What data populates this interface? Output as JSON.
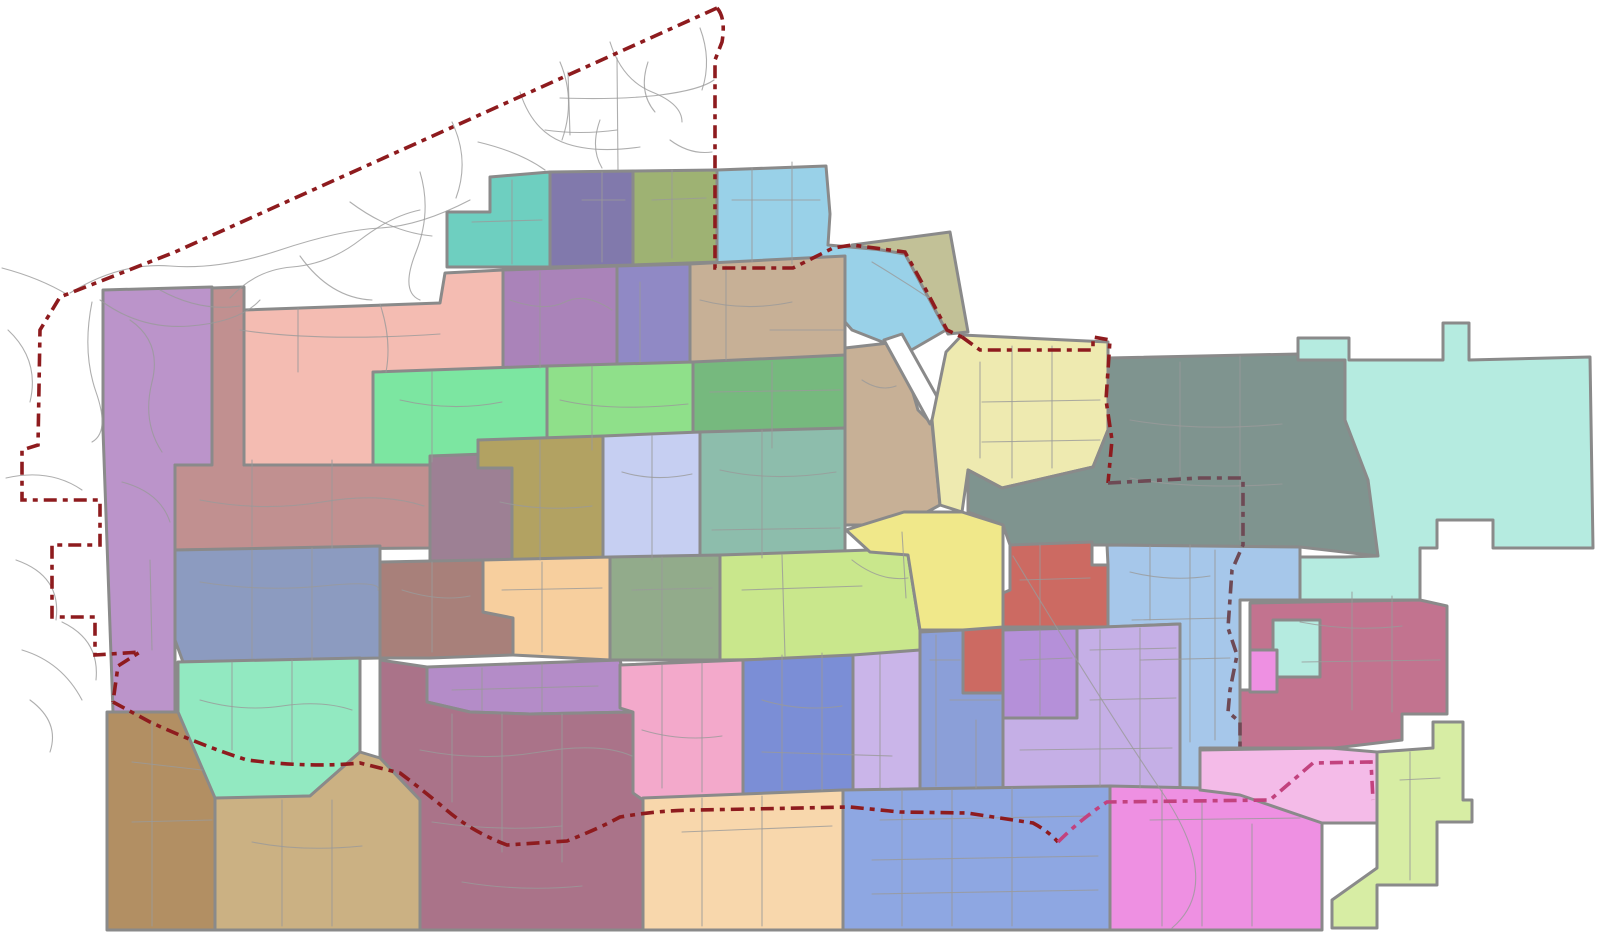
{
  "map": {
    "canvas": {
      "width": 1618,
      "height": 951,
      "background": "#ffffff"
    },
    "styles": {
      "region_stroke": "#8a8a8a",
      "region_stroke_width": 3,
      "road_color": "#9a9a9a",
      "road_width": 1.1,
      "road_opacity": 0.8,
      "boundary_width": 3.6,
      "boundary_dash": "13 6 5 6",
      "boundary_main_color": "#8e1b1e",
      "boundary_magenta_color": "#c2427e",
      "boundary_inner_color": "#6e4a55"
    },
    "regions": [
      {
        "id": "purple-strip-west",
        "fill": "#bb94ca",
        "points": "103,290 212,287 212,465 175,465 175,712 113,712 103,430"
      },
      {
        "id": "teal-north",
        "fill": "#6ecfc0",
        "points": "447,212 490,212 490,177 550,172 550,267 447,267"
      },
      {
        "id": "slate-purple-north",
        "fill": "#8179ac",
        "points": "550,172 633,171 633,265 550,267"
      },
      {
        "id": "moss-north",
        "fill": "#9eb273",
        "points": "633,171 717,170 717,262 633,265"
      },
      {
        "id": "light-blue-north",
        "fill": "#99d1e8",
        "points": "717,170 826,166 830,214 828,245 850,247 905,252 946,330 908,352 852,330 826,300 793,268 717,268"
      },
      {
        "id": "khaki-olive-ne",
        "fill": "#c2c197",
        "points": "852,245 950,232 968,332 948,334 905,254"
      },
      {
        "id": "rosy-brown-west",
        "fill": "#c19090",
        "points": "212,288 244,287 244,465 430,458 430,548 175,550 175,465 212,465"
      },
      {
        "id": "salmon",
        "fill": "#f4bcb2",
        "points": "244,310 440,303 445,273 503,270 503,370 373,373 373,465 244,465"
      },
      {
        "id": "mauve-central",
        "fill": "#aa83b9",
        "points": "503,270 617,266 617,368 503,370"
      },
      {
        "id": "purple-blue-central",
        "fill": "#9089c5",
        "points": "617,266 690,264 690,366 617,368"
      },
      {
        "id": "tan-central",
        "fill": "#c7b096",
        "points": "690,264 845,256 845,362 690,362"
      },
      {
        "id": "tan-east-arm",
        "fill": "#c7b096",
        "points": "845,348 898,342 918,410 932,424 940,505 903,525 845,525 845,430"
      },
      {
        "id": "white-corridor",
        "fill": "#ffffff",
        "points": "884,340 902,334 940,402 930,424"
      },
      {
        "id": "bright-green",
        "fill": "#7ce6a1",
        "points": "373,372 547,366 547,440 478,440 478,465 373,465"
      },
      {
        "id": "light-green",
        "fill": "#8fe08a",
        "points": "547,366 693,362 693,450 547,452"
      },
      {
        "id": "sage-green",
        "fill": "#76b97e",
        "points": "693,362 845,355 845,450 693,450"
      },
      {
        "id": "pale-yellow-east",
        "fill": "#eeeab0",
        "points": "946,352 962,335 1108,342 1108,430 1093,467 1002,488 968,470 962,512 940,505 932,420"
      },
      {
        "id": "slate-gray-green",
        "fill": "#7f948f",
        "points": "1108,430 1108,358 1345,353 1345,420 1368,480 1378,556 1300,547 1107,545 1010,545 1003,525 968,512 968,470 1002,488 1093,467"
      },
      {
        "id": "pale-cyan-east",
        "fill": "#b5ebe0",
        "points": "1345,360 1298,360 1298,338 1349,338 1349,360 1443,360 1443,323 1469,323 1469,360 1590,357 1593,548 1493,548 1493,520 1437,520 1437,548 1420,548 1420,600 1300,600 1300,557 1345,557 1378,556 1368,480 1345,420"
      },
      {
        "id": "mauve-gray-mid",
        "fill": "#9d8094",
        "points": "430,456 512,453 512,562 430,562"
      },
      {
        "id": "dark-khaki-mid",
        "fill": "#b2a262",
        "points": "478,440 603,436 603,562 512,562 512,468 478,468"
      },
      {
        "id": "lavender-blue-mid",
        "fill": "#c6cff2",
        "points": "603,436 700,432 700,562 603,562"
      },
      {
        "id": "teal-green-mid",
        "fill": "#8dbdac",
        "points": "700,432 845,428 845,555 700,558"
      },
      {
        "id": "slate-blue-west",
        "fill": "#8c9bc0",
        "points": "175,550 380,546 380,658 183,662 175,640"
      },
      {
        "id": "taupe-mid",
        "fill": "#a8807a",
        "points": "380,562 483,560 483,612 513,618 513,655 430,658 380,658"
      },
      {
        "id": "peach-mid",
        "fill": "#f7cf9e",
        "points": "483,560 610,557 610,660 513,655 513,618 483,612"
      },
      {
        "id": "sage-green-south",
        "fill": "#92ab8b",
        "points": "610,557 720,555 720,660 610,660"
      },
      {
        "id": "yellow-green-mid",
        "fill": "#c9e78c",
        "points": "720,555 870,550 908,555 920,630 920,658 720,660"
      },
      {
        "id": "yellow-central",
        "fill": "#f0e88a",
        "points": "846,530 904,512 962,512 1003,525 1003,630 920,630 908,555 870,552"
      },
      {
        "id": "coral",
        "fill": "#cc6a62",
        "points": "1010,545 1092,542 1092,565 1108,565 1108,627 1003,627 1003,593 1010,590"
      },
      {
        "id": "coral-arm",
        "fill": "#cc6a62",
        "points": "963,630 1003,627 1003,693 963,693"
      },
      {
        "id": "light-blue-east",
        "fill": "#a6c7ea",
        "points": "1107,545 1300,547 1300,600 1240,600 1240,748 1200,748 1200,790 1180,790 1180,624 1108,627 1108,565"
      },
      {
        "id": "rose-east",
        "fill": "#c2738f",
        "points": "1250,603 1420,600 1447,606 1447,714 1402,714 1402,740 1335,748 1240,748 1240,690 1250,690"
      },
      {
        "id": "cyan-arm",
        "fill": "#b5ebe0",
        "points": "1273,620 1320,620 1320,677 1273,677"
      },
      {
        "id": "pink-notch",
        "fill": "#ee90e2",
        "points": "1250,650 1277,650 1277,692 1250,692"
      },
      {
        "id": "mint-south",
        "fill": "#92e9c1",
        "points": "178,662 360,658 360,752 310,796 215,800 178,715"
      },
      {
        "id": "purple-south",
        "fill": "#b48cc8",
        "points": "427,667 620,660 633,712 530,714 470,712 427,702"
      },
      {
        "id": "plum-south",
        "fill": "#aa7389",
        "points": "380,660 427,667 427,702 470,712 530,714 633,712 643,722 643,930 420,930 420,800 380,758"
      },
      {
        "id": "pink-south",
        "fill": "#f3a9cb",
        "points": "620,665 743,660 743,795 643,800 633,793 633,712 620,708"
      },
      {
        "id": "blue-purple-south",
        "fill": "#7b8ed6",
        "points": "743,660 853,655 853,790 743,795"
      },
      {
        "id": "lavender-west",
        "fill": "#cab5e9",
        "points": "853,655 920,650 920,790 853,790"
      },
      {
        "id": "blue-mid-south",
        "fill": "#8b9fd8",
        "points": "920,632 963,630 963,693 1003,693 1003,790 920,790"
      },
      {
        "id": "purple-block",
        "fill": "#b590d9",
        "points": "1003,630 1077,628 1077,718 1003,718"
      },
      {
        "id": "lavender-east",
        "fill": "#c5afe6",
        "points": "1077,628 1180,624 1180,790 1003,790 1003,718 1077,718"
      },
      {
        "id": "brown-sw",
        "fill": "#b28f63",
        "points": "107,712 178,712 215,798 215,930 107,930"
      },
      {
        "id": "tan-south",
        "fill": "#cbb183",
        "points": "215,798 310,796 360,752 380,758 420,800 420,930 215,930"
      },
      {
        "id": "peach-south",
        "fill": "#f8d7ac",
        "points": "643,798 843,790 843,930 643,930"
      },
      {
        "id": "blue-south",
        "fill": "#8ea7e2",
        "points": "843,790 1110,786 1110,930 843,930"
      },
      {
        "id": "bright-pink-south",
        "fill": "#ee90e2",
        "points": "1110,786 1200,788 1200,750 1240,748 1330,748 1322,823 1322,930 1110,930"
      },
      {
        "id": "light-pink-south",
        "fill": "#f4bbe8",
        "points": "1200,750 1330,748 1377,752 1377,823 1322,823 1240,795 1200,790"
      },
      {
        "id": "pale-green-se",
        "fill": "#d7eda4",
        "points": "1377,752 1433,748 1433,722 1463,722 1463,800 1472,800 1472,822 1437,822 1437,885 1377,885 1377,928 1332,928 1332,900 1377,868"
      }
    ],
    "roads": [
      "M70,293 Q120,262 170,266 T280,250 T380,228 T470,200",
      "M100,300 Q140,330 190,326 T260,300",
      "M230,298 Q255,270 292,267 T360,240 T420,210",
      "M300,256 Q330,298 372,300",
      "M420,172 Q432,212 416,252 T420,300",
      "M452,122 Q470,160 456,198",
      "M520,92 Q532,130 562,142 T640,147",
      "M560,62 Q576,100 562,140",
      "M610,42 Q622,80 652,92 T682,122",
      "M478,142 Q520,152 545,170",
      "M350,202 Q390,232 432,236",
      "M160,290 Q200,312 240,306",
      "M600,120 Q590,148 602,168",
      "M648,62 Q638,92 655,112",
      "M617,58 L618,170",
      "M560,98 Q620,100 660,95 T714,80",
      "M545,130 Q580,135 617,130",
      "M568,72 L570,135",
      "M670,140 Q690,155 712,152",
      "M700,28 Q712,60 702,90",
      "M2,268 Q40,278 68,295",
      "M8,330 Q40,360 30,402",
      "M6,478 Q50,468 82,490",
      "M16,560 Q62,576 56,620",
      "M22,650 Q62,662 82,700",
      "M62,622 Q100,640 96,680",
      "M30,700 Q60,722 50,752",
      "M92,302 Q82,352 96,392 T92,442",
      "M240,330 Q320,342 440,334",
      "M298,308 L298,372",
      "M380,304 Q392,340 386,372",
      "M130,320 Q162,342 152,382 T162,452",
      "M122,482 Q160,492 170,522",
      "M150,560 L152,650",
      "M510,300 Q545,312 565,302 T612,310",
      "M540,272 L540,368",
      "M640,282 L640,362",
      "M700,300 Q745,312 792,302",
      "M726,266 L726,360",
      "M770,330 L843,330",
      "M400,400 Q452,412 502,402",
      "M432,372 L432,462",
      "M560,400 Q610,412 688,404",
      "M592,366 L592,450",
      "M710,392 L840,390",
      "M772,362 L772,448",
      "M200,500 Q262,512 322,502 T424,506",
      "M252,460 L252,546",
      "M332,460 L332,548",
      "M500,502 Q545,512 592,506",
      "M540,440 L540,560",
      "M622,472 Q655,482 692,474",
      "M652,436 L652,560",
      "M720,470 Q772,482 836,472",
      "M762,430 L762,558",
      "M712,530 L840,528",
      "M200,582 Q262,592 322,586 T378,590",
      "M252,550 L252,658",
      "M312,548 L312,660",
      "M402,590 Q440,602 470,596",
      "M432,562 L432,652",
      "M502,590 L602,588",
      "M542,562 L542,652",
      "M632,590 L712,588",
      "M662,557 L662,656",
      "M742,590 L862,586",
      "M782,555 L785,656",
      "M852,560 Q880,582 908,578",
      "M902,532 L906,598",
      "M980,362 L980,458",
      "M1012,346 L1012,478",
      "M1052,346 L1052,468",
      "M982,402 L1100,400",
      "M982,442 L1100,440",
      "M872,262 Q902,280 932,300",
      "M862,380 Q880,392 896,386",
      "M732,200 L820,200",
      "M752,168 L752,262",
      "M792,162 L792,264",
      "M472,222 L542,220",
      "M512,180 L512,264",
      "M582,200 L625,200",
      "M602,172 L602,262",
      "M652,200 L706,198",
      "M672,170 L672,258",
      "M1130,420 Q1200,432 1282,424",
      "M1180,362 L1180,476",
      "M1240,356 L1240,540",
      "M1130,478 Q1190,490 1282,484",
      "M1020,580 L1090,578",
      "M1040,545 L1040,625",
      "M420,750 Q480,762 540,752 T632,756",
      "M452,714 L452,802",
      "M502,714 L502,852",
      "M562,714 L562,862",
      "M432,822 Q500,832 562,826",
      "M462,882 Q522,892 582,886",
      "M200,700 Q242,712 282,706 T352,710",
      "M232,662 L232,750",
      "M292,660 L292,762",
      "M452,690 L598,686",
      "M482,668 L482,710",
      "M542,664 L542,712",
      "M642,730 Q682,742 722,736",
      "M662,665 L662,788",
      "M702,663 L702,792",
      "M762,700 Q802,712 842,706",
      "M782,655 L782,790",
      "M822,653 L822,790",
      "M762,752 L892,756",
      "M880,655 L880,788",
      "M930,660 L960,660",
      "M936,635 L936,786",
      "M950,700 L1000,700",
      "M976,720 L976,788",
      "M1020,660 L1072,658",
      "M1040,630 L1040,715",
      "M1090,650 L1176,648",
      "M1100,630 L1100,786",
      "M1140,628 L1140,788",
      "M1020,750 L1172,748",
      "M1090,700 L1176,698",
      "M1130,572 Q1170,582 1210,576",
      "M1150,546 L1150,620",
      "M1190,545 L1190,742",
      "M1215,550 L1215,740",
      "M1132,620 L1228,618",
      "M1140,660 L1230,658",
      "M1300,622 Q1352,632 1402,626",
      "M1352,592 L1352,710",
      "M1392,596 L1392,712",
      "M1302,662 L1440,660",
      "M1150,820 L1300,818",
      "M1162,790 L1162,926",
      "M1202,800 L1202,926",
      "M1252,824 L1252,926",
      "M880,820 L1092,816",
      "M902,790 L902,926",
      "M952,790 L952,926",
      "M1012,788 L1012,926",
      "M872,860 L1098,856",
      "M872,894 L1098,890",
      "M682,832 L832,826",
      "M702,798 L702,926",
      "M762,796 L762,926",
      "M252,842 Q302,852 362,846",
      "M282,800 L282,926",
      "M332,800 L332,926",
      "M132,762 L202,770",
      "M152,722 L152,926",
      "M132,822 L212,820",
      "M1013,556 Q1100,700 1162,792 T1172,928",
      "M1400,780 L1440,778",
      "M1410,752 L1410,880"
    ],
    "boundaries": [
      {
        "id": "city-limit-northwest",
        "color": "#8e1b1e",
        "d": "M717,8 L175,252 L60,297 L40,330 L38,445 L22,450 L22,500 L100,500 L100,545 L52,545 L52,617 L95,617 L95,655 L140,652 L118,666 L113,702"
      },
      {
        "id": "city-limit-south",
        "color": "#8e1b1e",
        "d": "M113,702 L150,722 Q200,745 247,760 Q310,768 360,763 L400,773 Q420,788 443,807 Q470,831 507,845 L567,841 Q600,828 620,817 Q660,810 700,810 L850,807 L900,812 L967,813 L1033,823 Q1048,831 1058,842"
      },
      {
        "id": "city-limit-southeast",
        "color": "#c2427e",
        "d": "M1058,842 Q1082,818 1107,802 L1270,800 L1313,763 L1371,762 L1373,800"
      },
      {
        "id": "city-limit-northeast",
        "color": "#8e1b1e",
        "d": "M717,8 Q726,18 722,42 L715,60 L715,268 L793,268 L833,248 L852,245 L905,252 L926,290 L947,330 L962,337"
      },
      {
        "id": "city-limit-east-top",
        "color": "#8e1b1e",
        "d": "M962,337 L980,350 L1093,350 L1093,337 L1110,340 L1106,400 L1112,440 L1108,483"
      },
      {
        "id": "annex-boundary-east",
        "color": "#6e4a55",
        "d": "M1108,483 L1200,478 L1243,478 L1243,545 L1232,570 L1228,628 L1237,655 L1230,690 L1228,712 L1240,722 L1240,748"
      }
    ]
  }
}
